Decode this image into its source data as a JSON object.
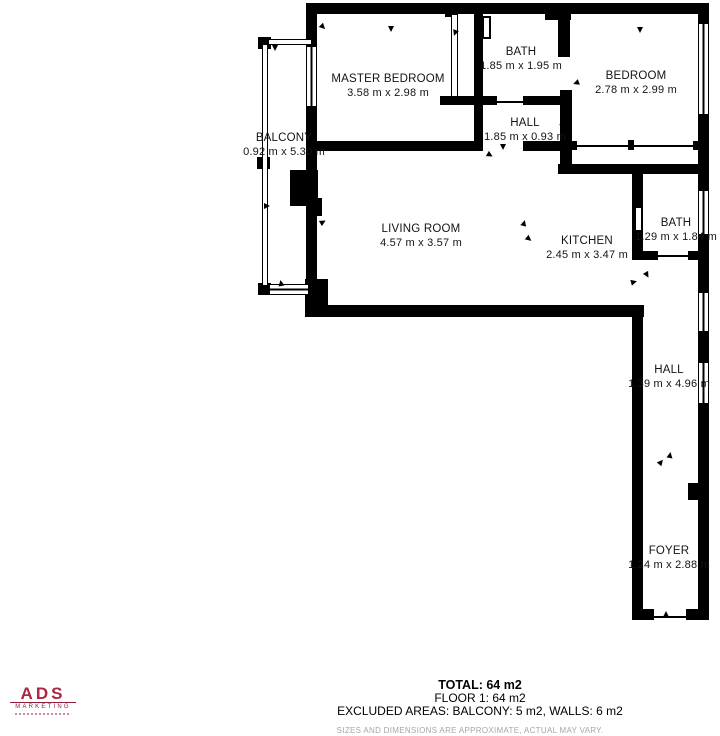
{
  "plan": {
    "rooms": [
      {
        "name": "MASTER BEDROOM",
        "dims": "3.58 m x 2.98 m"
      },
      {
        "name": "BATH",
        "dims": "1.85 m x 1.95 m"
      },
      {
        "name": "BEDROOM",
        "dims": "2.78 m x 2.99 m"
      },
      {
        "name": "HALL",
        "dims": "1.85 m x 0.93 m"
      },
      {
        "name": "BALCONY",
        "dims": "0.92 m x 5.30 m"
      },
      {
        "name": "LIVING ROOM",
        "dims": "4.57 m x 3.57 m"
      },
      {
        "name": "KITCHEN",
        "dims": "2.45 m x 3.47 m"
      },
      {
        "name": "BATH",
        "dims": "1.29 m x 1.84 m"
      },
      {
        "name": "HALL",
        "dims": "1.39 m x 4.96 m"
      },
      {
        "name": "FOYER",
        "dims": "1.24 m x 2.88 m"
      }
    ]
  },
  "footer": {
    "total": "TOTAL: 64 m2",
    "floor": "FLOOR 1: 64 m2",
    "excluded": "EXCLUDED AREAS: BALCONY: 5 m2, WALLS: 6 m2",
    "disclaimer": "SIZES AND DIMENSIONS ARE APPROXIMATE, ACTUAL MAY VARY."
  },
  "logo": {
    "brand": "ADS",
    "sub": "MARKETING"
  },
  "colors": {
    "wall": "#000000",
    "logo_red": "#ab2742",
    "disclaimer_gray": "#a6a6a6"
  }
}
